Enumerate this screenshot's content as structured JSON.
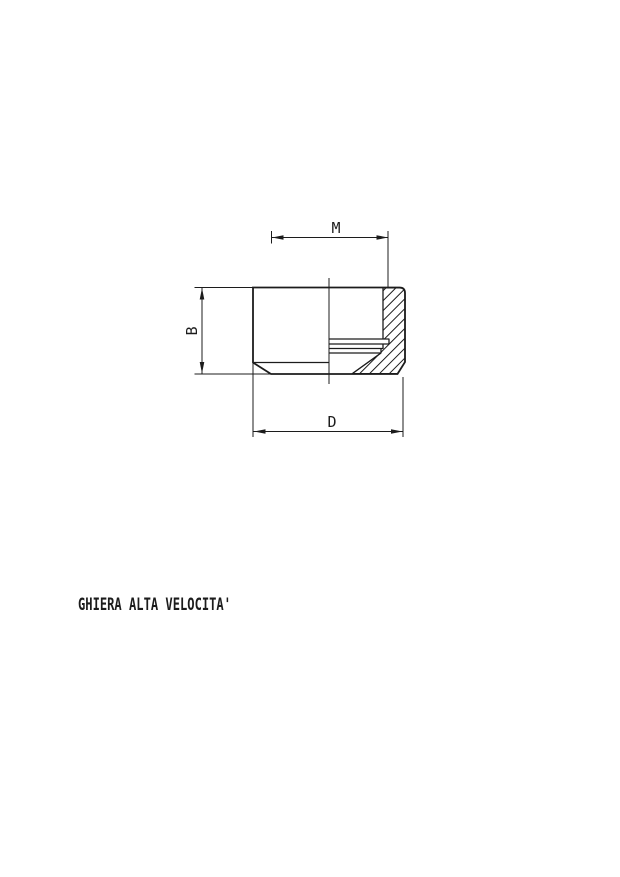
{
  "drawing": {
    "type": "technical-section-view",
    "title": "GHIERA ALTA VELOCITA'",
    "dimensions": [
      {
        "label": "M",
        "orientation": "horizontal",
        "position": "top"
      },
      {
        "label": "B",
        "orientation": "vertical",
        "position": "left"
      },
      {
        "label": "D",
        "orientation": "horizontal",
        "position": "bottom"
      }
    ],
    "colors": {
      "line": "#1c1c1c",
      "background": "#ffffff"
    }
  }
}
